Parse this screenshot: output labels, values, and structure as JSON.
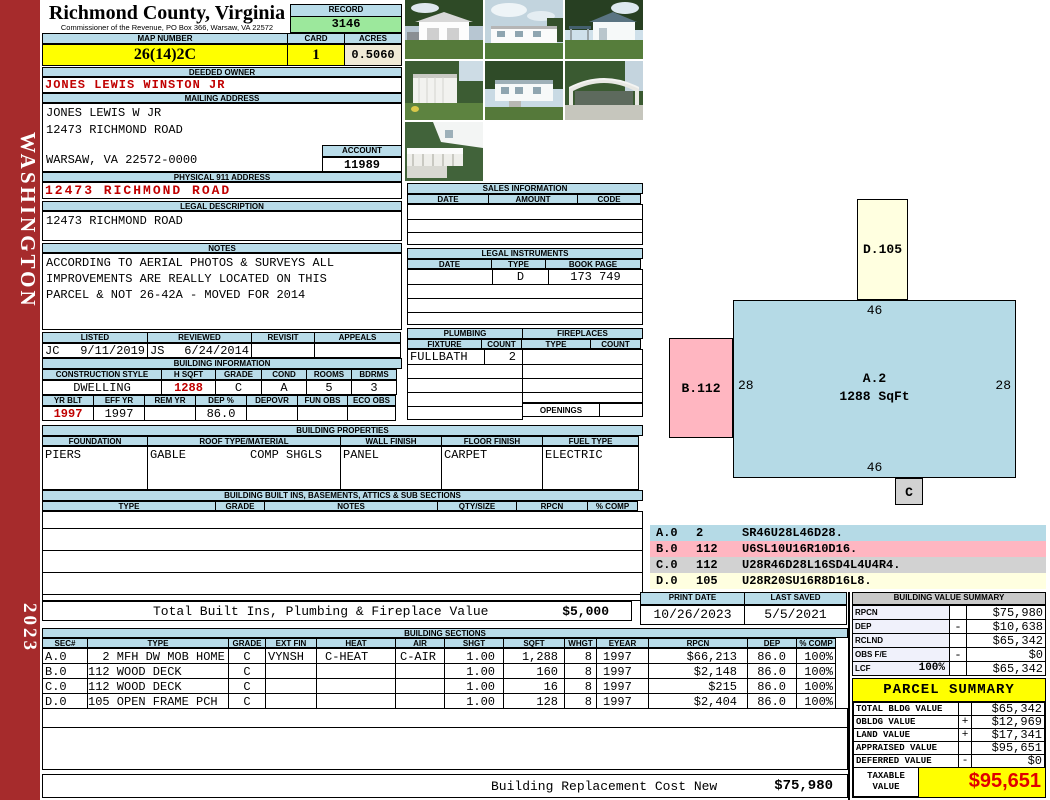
{
  "sidebar": {
    "district": "WASHINGTON",
    "year": "2023"
  },
  "header": {
    "county": "Richmond County, Virginia",
    "commissioner": "Commissioner of the Revenue, PO Box 366, Warsaw, VA 22572",
    "record_label": "RECORD",
    "record_value": "3146"
  },
  "parcel": {
    "map_number_label": "MAP NUMBER",
    "map_number": "26(14)2C",
    "card_label": "CARD",
    "card": "1",
    "acres_label": "ACRES",
    "acres": "0.5060"
  },
  "owner": {
    "deeded_label": "DEEDED OWNER",
    "deeded": "JONES LEWIS WINSTON JR",
    "mailing_label": "MAILING ADDRESS",
    "mail1": "JONES LEWIS W JR",
    "mail2": "12473 RICHMOND ROAD",
    "mail3": "WARSAW, VA 22572-0000",
    "account_label": "ACCOUNT",
    "account": "11989",
    "physical_label": "PHYSICAL 911 ADDRESS",
    "physical": "12473 RICHMOND ROAD",
    "legal_label": "LEGAL DESCRIPTION",
    "legal": "12473 RICHMOND ROAD"
  },
  "notes": {
    "label": "NOTES",
    "line1": "ACCORDING TO AERIAL PHOTOS & SURVEYS ALL",
    "line2": "IMPROVEMENTS ARE REALLY LOCATED ON THIS",
    "line3": "PARCEL & NOT 26-42A - MOVED FOR 2014"
  },
  "review": {
    "listed_label": "LISTED",
    "listed_by": "JC",
    "listed_date": "9/11/2019",
    "reviewed_label": "REVIEWED",
    "reviewed_by": "JS",
    "reviewed_date": "6/24/2014",
    "revisit_label": "REVISIT",
    "appeals_label": "APPEALS"
  },
  "building_info": {
    "label": "BUILDING INFORMATION",
    "style_label": "CONSTRUCTION STYLE",
    "style": "DWELLING",
    "hsqft_label": "H SQFT",
    "hsqft": "1288",
    "grade_label": "GRADE",
    "grade": "C",
    "cond_label": "COND",
    "cond": "A",
    "rooms_label": "ROOMS",
    "rooms": "5",
    "bdrms_label": "BDRMS",
    "bdrms": "3",
    "yrblt_label": "YR BLT",
    "yrblt": "1997",
    "effyr_label": "EFF YR",
    "effyr": "1997",
    "remyr_label": "REM YR",
    "dep_label": "DEP %",
    "dep": "86.0",
    "depovr_label": "DEPOVR",
    "funobs_label": "FUN OBS",
    "ecoobs_label": "ECO OBS"
  },
  "properties": {
    "label": "BUILDING PROPERTIES",
    "foundation_label": "FOUNDATION",
    "foundation": "PIERS",
    "roof_label": "ROOF TYPE/MATERIAL",
    "roof_type": "GABLE",
    "roof_material": "COMP SHGLS",
    "wall_label": "WALL FINISH",
    "wall": "PANEL",
    "floor_label": "FLOOR FINISH",
    "floor": "CARPET",
    "fuel_label": "FUEL TYPE",
    "fuel": "ELECTRIC"
  },
  "built_ins": {
    "label": "BUILDING BUILT INS, BASEMENTS, ATTICS & SUB SECTIONS",
    "h_type": "TYPE",
    "h_grade": "GRADE",
    "h_notes": "NOTES",
    "h_qty": "QTY/SIZE",
    "h_rpcn": "RPCN",
    "h_comp": "% COMP",
    "total_label": "Total Built Ins, Plumbing & Fireplace Value",
    "total_value": "$5,000"
  },
  "sales": {
    "label": "SALES INFORMATION",
    "h_date": "DATE",
    "h_amount": "AMOUNT",
    "h_code": "CODE"
  },
  "legal_instruments": {
    "label": "LEGAL INSTRUMENTS",
    "h_date": "DATE",
    "h_type": "TYPE",
    "h_book": "BOOK PAGE",
    "row1_type": "D",
    "row1_book": "173 749"
  },
  "plumbing": {
    "label": "PLUMBING",
    "h_fixture": "FIXTURE",
    "h_count": "COUNT",
    "row1_fixture": "FULLBATH",
    "row1_count": "2"
  },
  "fireplaces": {
    "label": "FIREPLACES",
    "h_type": "TYPE",
    "h_count": "COUNT",
    "openings_label": "OPENINGS"
  },
  "photos": {
    "items": [
      "detached-garage",
      "mobile-home-front",
      "house-with-carport",
      "storage-shed",
      "mobile-home-steps",
      "metal-carport",
      "porch-deck"
    ]
  },
  "sketch": {
    "a_label": "A.2",
    "a_sqft": "1288 SqFt",
    "b_label": "B.112",
    "c_label": "C",
    "d_label": "D.105",
    "dim_top": "46",
    "dim_bottom": "46",
    "dim_left": "28",
    "dim_right": "28",
    "colors": {
      "a": "#B5DAE6",
      "b": "#FFB6C1",
      "c": "#D2D2D2",
      "d": "#FFFFE0"
    }
  },
  "legend": {
    "rows": [
      {
        "sec": "A.0",
        "code": "2",
        "trace": "SR46U28L46D28."
      },
      {
        "sec": "B.0",
        "code": "112",
        "trace": "U6SL10U16R10D16."
      },
      {
        "sec": "C.0",
        "code": "112",
        "trace": "U28R46D28L16SD4L4U4R4."
      },
      {
        "sec": "D.0",
        "code": "105",
        "trace": "U28R20SU16R8D16L8."
      }
    ]
  },
  "print_info": {
    "print_label": "PRINT DATE",
    "print_date": "10/26/2023",
    "saved_label": "LAST SAVED",
    "saved_date": "5/5/2021"
  },
  "value_summary": {
    "label": "BUILDING VALUE SUMMARY",
    "rows": [
      {
        "label": "RPCN",
        "pct": "",
        "sign": "",
        "value": "$75,980"
      },
      {
        "label": "DEP",
        "pct": "",
        "sign": "-",
        "value": "$10,638"
      },
      {
        "label": "RCLND",
        "pct": "",
        "sign": "",
        "value": "$65,342"
      },
      {
        "label": "OBS F/E",
        "pct": "",
        "sign": "-",
        "value": "$0"
      },
      {
        "label": "LCF",
        "pct": "100%",
        "sign": "",
        "value": "$65,342"
      }
    ]
  },
  "building_sections": {
    "label": "BUILDING SECTIONS",
    "h_sec": "SEC#",
    "h_type": "TYPE",
    "h_grade": "GRADE",
    "h_extfin": "EXT FIN",
    "h_heat": "HEAT",
    "h_air": "AIR",
    "h_shgt": "SHGT",
    "h_sqft": "SQFT",
    "h_whgt": "WHGT",
    "h_eyear": "EYEAR",
    "h_rpcn": "RPCN",
    "h_dep": "DEP",
    "h_comp": "% COMP",
    "rows": [
      {
        "sec": "A.0",
        "type": "  2 MFH DW MOB HOME",
        "grade": "C",
        "extfin": "VYNSH",
        "heat": "C-HEAT",
        "air": "C-AIR",
        "shgt": "1.00",
        "sqft": "1,288",
        "whgt": "8",
        "eyear": "1997",
        "rpcn": "$66,213",
        "dep": "86.0",
        "comp": "100%"
      },
      {
        "sec": "B.0",
        "type": "112 WOOD DECK",
        "grade": "C",
        "extfin": "",
        "heat": "",
        "air": "",
        "shgt": "1.00",
        "sqft": "160",
        "whgt": "8",
        "eyear": "1997",
        "rpcn": "$2,148",
        "dep": "86.0",
        "comp": "100%"
      },
      {
        "sec": "C.0",
        "type": "112 WOOD DECK",
        "grade": "C",
        "extfin": "",
        "heat": "",
        "air": "",
        "shgt": "1.00",
        "sqft": "16",
        "whgt": "8",
        "eyear": "1997",
        "rpcn": "$215",
        "dep": "86.0",
        "comp": "100%"
      },
      {
        "sec": "D.0",
        "type": "105 OPEN FRAME PCH",
        "grade": "C",
        "extfin": "",
        "heat": "",
        "air": "",
        "shgt": "1.00",
        "sqft": "128",
        "whgt": "8",
        "eyear": "1997",
        "rpcn": "$2,404",
        "dep": "86.0",
        "comp": "100%"
      }
    ],
    "replacement_label": "Building Replacement Cost New",
    "replacement_value": "$75,980"
  },
  "parcel_summary": {
    "label": "PARCEL SUMMARY",
    "rows": [
      {
        "label": "TOTAL BLDG VALUE",
        "sign": "",
        "value": "$65,342"
      },
      {
        "label": "OBLDG VALUE",
        "sign": "+",
        "value": "$12,969"
      },
      {
        "label": "LAND VALUE",
        "sign": "+",
        "value": "$17,341"
      },
      {
        "label": "APPRAISED VALUE",
        "sign": "",
        "value": "$95,651"
      },
      {
        "label": "DEFERRED VALUE",
        "sign": "-",
        "value": "$0"
      }
    ],
    "taxable_label1": "TAXABLE",
    "taxable_label2": "VALUE",
    "taxable_value": "$95,651"
  },
  "colors": {
    "sidebar": "#A62B2C",
    "section_header": "#B9DCE9",
    "highlight_yellow": "#FFFF00",
    "record_green": "#9CE89C",
    "acres_cream": "#F0EAD6",
    "alert_red": "#C00000"
  }
}
